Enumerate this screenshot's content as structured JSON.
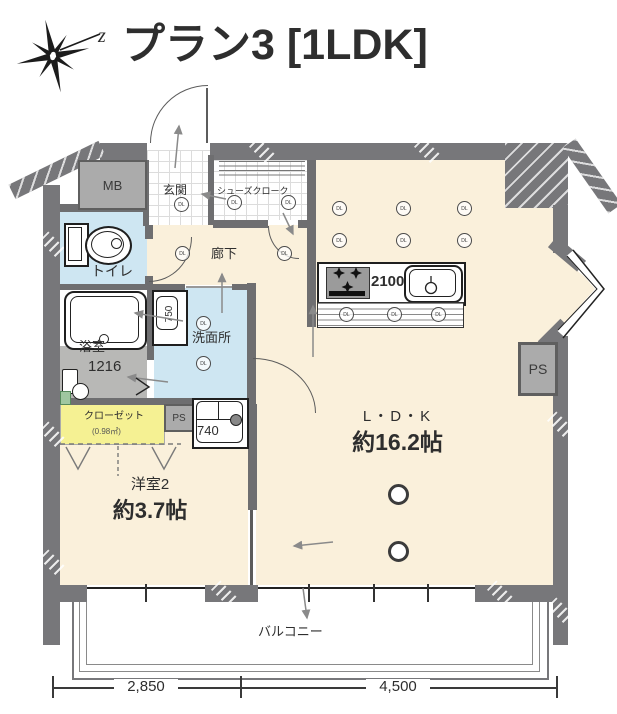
{
  "page_title": "プラン3 [1LDK]",
  "compass": {
    "north_label": "z"
  },
  "rooms": {
    "mb": "MB",
    "entrance": "玄関",
    "shoe_closet": "シューズクローク",
    "hallway": "廊下",
    "toilet": "トイレ",
    "bathroom": "浴室",
    "bathroom_size": "1216",
    "washroom": "洗面所",
    "vanity_width": "750",
    "washer_width": "740",
    "ps_left": "PS",
    "ps_right": "PS",
    "closet": "クローゼット",
    "closet_area": "(0.98㎡)",
    "bedroom": "洋室2",
    "bedroom_area": "約3.7帖",
    "ldk": "L・D・K",
    "ldk_area": "約16.2帖",
    "kitchen_width": "2100",
    "balcony": "バルコニー"
  },
  "dimensions": {
    "bottom_left": "2,850",
    "bottom_right": "4,500"
  },
  "symbols": {
    "downlight": "DL"
  },
  "colors": {
    "wall": "#77777a",
    "room_cream": "#faf0db",
    "room_blue": "#cee6f2",
    "closet_yellow": "#f5f193",
    "bath_floor": "#b8b8b6",
    "fixture_gray": "#ababab"
  }
}
